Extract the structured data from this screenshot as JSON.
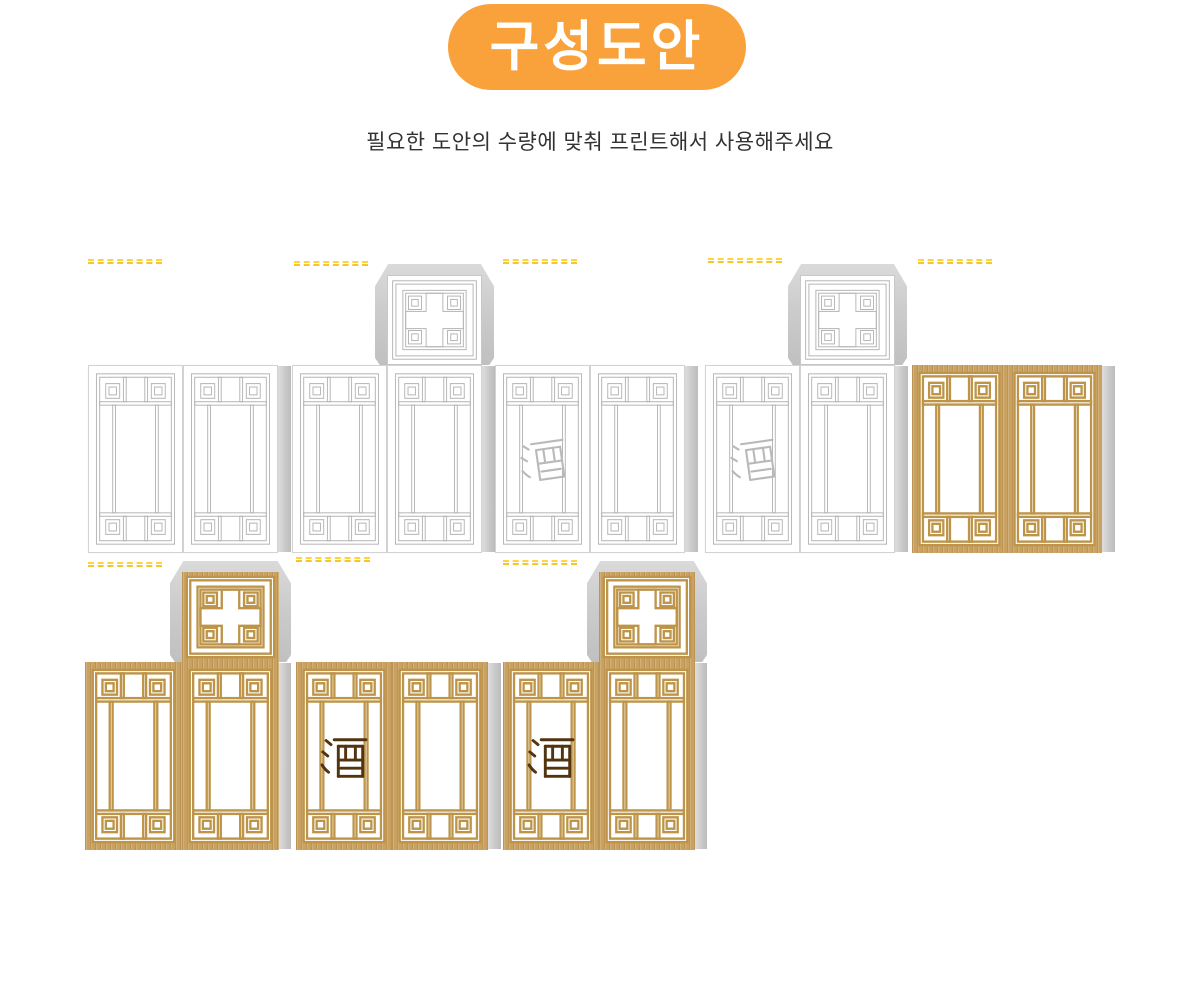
{
  "page": {
    "width": 1200,
    "height": 999,
    "background": "#ffffff"
  },
  "header": {
    "badge_label": "구성도안",
    "badge_color": "#f9a23b",
    "badge_text_color": "#ffffff",
    "subtitle": "필요한 도안의 수량에 맞춰 프린트해서 사용해주세요",
    "subtitle_color": "#333333"
  },
  "glyph": {
    "character": "酒",
    "outline_color": "#b9b9b9",
    "solid_color": "#533411"
  },
  "colors": {
    "white_lattice": "#b3b3b3",
    "panel_border": "#d3d3d3",
    "gold_wood": "#c9a160",
    "gold_lattice": "#bd9448",
    "glue_flap_light": "#dadada",
    "glue_flap_dark": "#c0c0c0",
    "watermark_yellow": "#fed33c"
  },
  "groups": [
    {
      "id": "top-1",
      "x": 88,
      "y": 365,
      "panel_w": 95,
      "panel_h": 188,
      "theme": "white",
      "lid": null,
      "panels": [
        "plain",
        "plain"
      ],
      "dash": {
        "x": 88,
        "y": 259
      },
      "tab_w": 13
    },
    {
      "id": "top-2",
      "x": 292,
      "y": 365,
      "panel_w": 95,
      "panel_h": 188,
      "theme": "white",
      "lid": "right",
      "panels": [
        "plain",
        "plain"
      ],
      "dash": {
        "x": 294,
        "y": 261
      },
      "tab_w": 13
    },
    {
      "id": "top-3",
      "x": 495,
      "y": 365,
      "panel_w": 95,
      "panel_h": 188,
      "theme": "white",
      "lid": null,
      "panels": [
        "jiu-outline",
        "plain"
      ],
      "dash": {
        "x": 503,
        "y": 259
      },
      "tab_w": 13
    },
    {
      "id": "top-4",
      "x": 705,
      "y": 365,
      "panel_w": 95,
      "panel_h": 188,
      "theme": "white",
      "lid": "right",
      "panels": [
        "jiu-outline",
        "plain"
      ],
      "dash": {
        "x": 708,
        "y": 258
      },
      "tab_w": 13
    },
    {
      "id": "top-5",
      "x": 912,
      "y": 365,
      "panel_w": 95,
      "panel_h": 188,
      "theme": "gold",
      "lid": null,
      "panels": [
        "plain",
        "plain"
      ],
      "dash": {
        "x": 918,
        "y": 259
      },
      "tab_w": 13
    },
    {
      "id": "bottom-1",
      "x": 85,
      "y": 662,
      "panel_w": 97,
      "panel_h": 188,
      "theme": "gold",
      "lid": "right",
      "panels": [
        "plain",
        "plain"
      ],
      "dash": {
        "x": 88,
        "y": 562
      },
      "tab_w": 12
    },
    {
      "id": "bottom-2",
      "x": 296,
      "y": 662,
      "panel_w": 96,
      "panel_h": 188,
      "theme": "gold",
      "lid": null,
      "panels": [
        "jiu-solid",
        "plain"
      ],
      "dash": {
        "x": 296,
        "y": 557
      },
      "tab_w": 13
    },
    {
      "id": "bottom-3",
      "x": 503,
      "y": 662,
      "panel_w": 96,
      "panel_h": 188,
      "theme": "gold",
      "lid": "right",
      "panels": [
        "jiu-solid",
        "plain"
      ],
      "dash": {
        "x": 503,
        "y": 560
      },
      "tab_w": 12
    }
  ],
  "lid_geometry": {
    "square_h": 90,
    "backing_h": 101,
    "backing_extra_w": 24,
    "square_drop": 11
  }
}
